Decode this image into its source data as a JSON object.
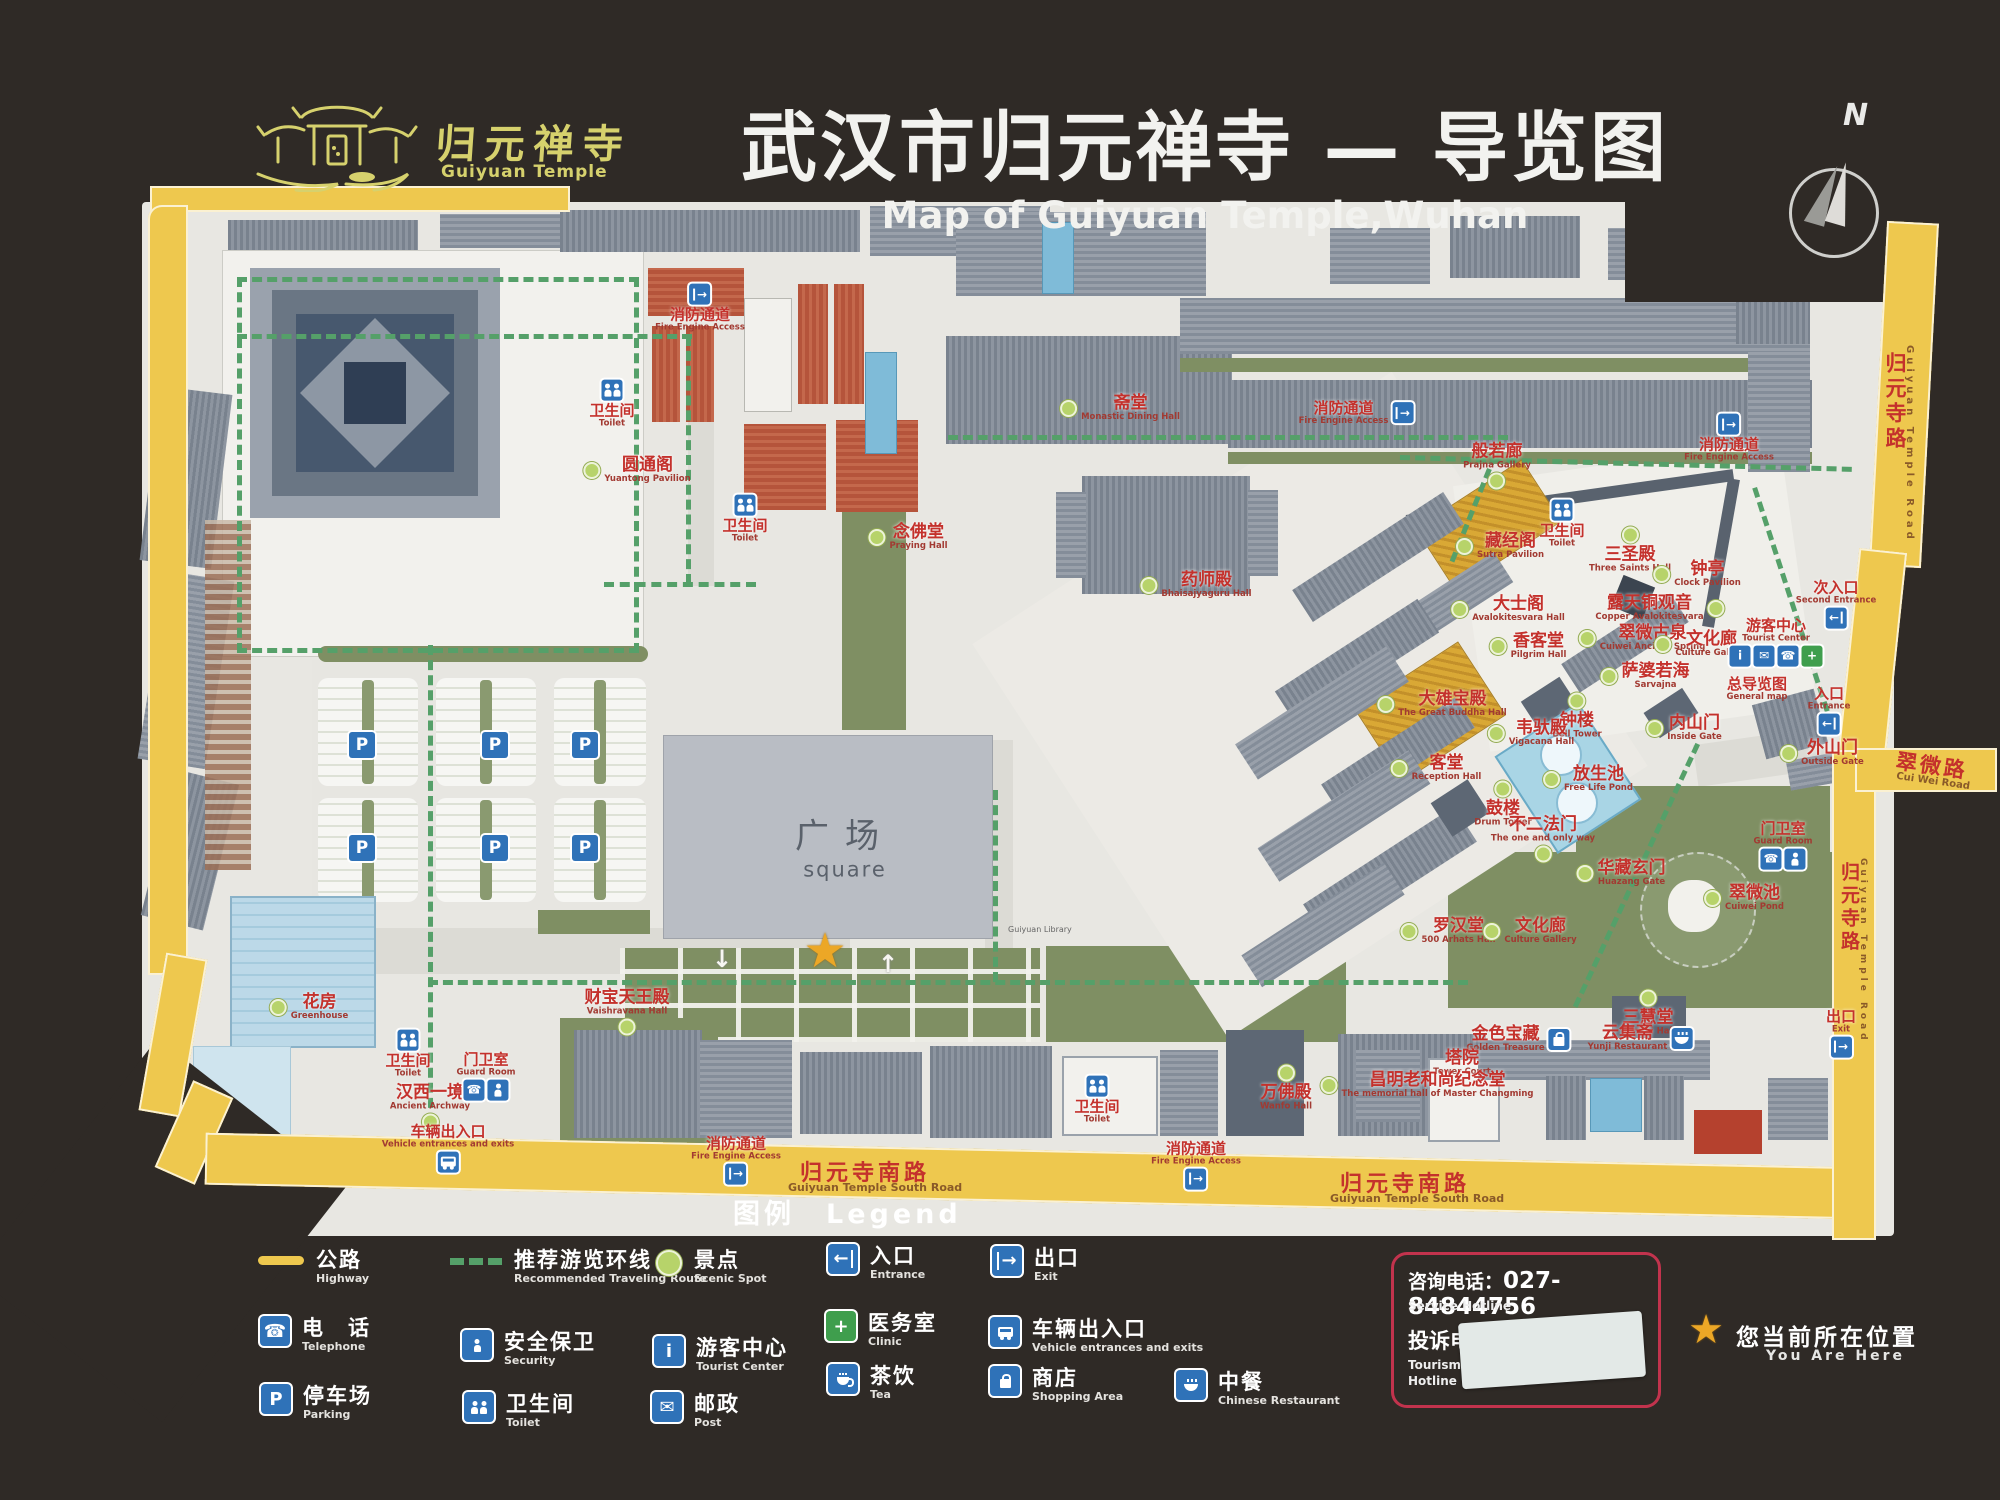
{
  "board": {
    "logo": {
      "name_zh": "归元禅寺",
      "name_en": "Guiyuan Temple"
    },
    "title_zh": "武汉市归元禅寺 — 导览图",
    "title_en": "Map of Guiyuan Temple,Wuhan",
    "compass_label": "N"
  },
  "map": {
    "square": {
      "zh": "广场",
      "en": "square"
    },
    "library_note": "Guiyuan Library",
    "roads": {
      "right_upper": {
        "zh": "归元寺路",
        "en": "Guiyuan Temple Road"
      },
      "right_lower": {
        "zh": "归元寺路",
        "en": "Guiyuan Temple Road"
      },
      "cuiwei": {
        "zh": "翠微路",
        "en": "Cui Wei Road"
      },
      "south_w": {
        "zh": "归元寺南路",
        "en": "Guiyuan Temple South Road"
      },
      "south_e": {
        "zh": "归元寺南路",
        "en": "Guiyuan Temple South Road"
      }
    },
    "spots": [
      {
        "zh": "圆通阁",
        "en": "Yuantong Pavilion",
        "x": 637,
        "y": 470,
        "dot": "left"
      },
      {
        "zh": "念佛堂",
        "en": "Praying Hall",
        "x": 908,
        "y": 537,
        "dot": "left"
      },
      {
        "zh": "斋堂",
        "en": "Monastic Dining Hall",
        "x": 1120,
        "y": 408,
        "dot": "left"
      },
      {
        "zh": "药师殿",
        "en": "Bhaisajyaguru Hall",
        "x": 1196,
        "y": 585,
        "dot": "left"
      },
      {
        "zh": "般若廊",
        "en": "Prajna Gallery",
        "x": 1497,
        "y": 466,
        "dot": "bottom"
      },
      {
        "zh": "藏经阁",
        "en": "Sutra Pavilion",
        "x": 1500,
        "y": 546,
        "dot": "left"
      },
      {
        "zh": "三圣殿",
        "en": "Three Saints Hall",
        "x": 1630,
        "y": 550,
        "dot": "top"
      },
      {
        "zh": "钟亭",
        "en": "Clock Pavilion",
        "x": 1697,
        "y": 574,
        "dot": "left"
      },
      {
        "zh": "大士阁",
        "en": "Avalokitesvara Hall",
        "x": 1508,
        "y": 609,
        "dot": "left"
      },
      {
        "zh": "露天铜观音",
        "en": "Copper Avalokitesvara",
        "x": 1660,
        "y": 608,
        "dot": "right"
      },
      {
        "zh": "翠微古泉",
        "en": "Cuiwei Ancient Spring",
        "x": 1642,
        "y": 638,
        "dot": "left"
      },
      {
        "zh": "文化廊",
        "en": "Culture Gallery",
        "x": 1701,
        "y": 644,
        "dot": "left"
      },
      {
        "zh": "香客堂",
        "en": "Pilgrim Hall",
        "x": 1528,
        "y": 646,
        "dot": "left"
      },
      {
        "zh": "萨婆若海",
        "en": "Sarvajna",
        "x": 1645,
        "y": 676,
        "dot": "left"
      },
      {
        "zh": "大雄宝殿",
        "en": "The Great Buddha Hall",
        "x": 1442,
        "y": 704,
        "dot": "left"
      },
      {
        "zh": "钟楼",
        "en": "Bell Tower",
        "x": 1577,
        "y": 716,
        "dot": "top"
      },
      {
        "zh": "韦驮殿",
        "en": "Vigacana Hall",
        "x": 1531,
        "y": 733,
        "dot": "left"
      },
      {
        "zh": "客堂",
        "en": "Reception Hall",
        "x": 1436,
        "y": 768,
        "dot": "left"
      },
      {
        "zh": "放生池",
        "en": "Free Life Pond",
        "x": 1588,
        "y": 779,
        "dot": "left"
      },
      {
        "zh": "鼓楼",
        "en": "Drum Tower",
        "x": 1503,
        "y": 804,
        "dot": "top"
      },
      {
        "zh": "不二法门",
        "en": "The one and only way",
        "x": 1543,
        "y": 839,
        "dot": "bottom"
      },
      {
        "zh": "华藏玄门",
        "en": "Huazang Gate",
        "x": 1621,
        "y": 873,
        "dot": "left"
      },
      {
        "zh": "内山门",
        "en": "Inside Gate",
        "x": 1684,
        "y": 728,
        "dot": "left"
      },
      {
        "zh": "外山门",
        "en": "Outside Gate",
        "x": 1822,
        "y": 753,
        "dot": "left"
      },
      {
        "zh": "罗汉堂",
        "en": "500 Arhats Hall",
        "x": 1448,
        "y": 931,
        "dot": "left"
      },
      {
        "zh": "文化廊",
        "en": "Culture Gallery",
        "x": 1530,
        "y": 931,
        "dot": "left"
      },
      {
        "zh": "翠微池",
        "en": "Cuiwei Pond",
        "x": 1744,
        "y": 898,
        "dot": "left"
      },
      {
        "zh": "三慧堂",
        "en": "Sanhui Hall",
        "x": 1648,
        "y": 1013,
        "dot": "top"
      },
      {
        "zh": "金色宝藏",
        "en": "Golden Treasure",
        "x": 1518,
        "y": 1039,
        "dot": "none",
        "icon": "shop"
      },
      {
        "zh": "云集斋",
        "en": "Yunji Restaurant",
        "x": 1640,
        "y": 1038,
        "dot": "none",
        "icon": "restaurant"
      },
      {
        "zh": "塔院",
        "en": "Tower Court",
        "x": 1462,
        "y": 1063,
        "dot": "none"
      },
      {
        "zh": "昌明老和尚纪念堂",
        "en": "The memorial hall of Master Changming",
        "x": 1427,
        "y": 1085,
        "dot": "left"
      },
      {
        "zh": "万佛殿",
        "en": "Wanfo Hall",
        "x": 1286,
        "y": 1088,
        "dot": "top"
      },
      {
        "zh": "汉西一境",
        "en": "Ancient Archway",
        "x": 430,
        "y": 1107,
        "dot": "bottom"
      },
      {
        "zh": "花房",
        "en": "Greenhouse",
        "x": 309,
        "y": 1007,
        "dot": "left"
      },
      {
        "zh": "财宝天王殿",
        "en": "Vaishravana Hall",
        "x": 627,
        "y": 1012,
        "dot": "bottom"
      }
    ],
    "facilities": [
      {
        "zh": "卫生间",
        "en": "Toilet",
        "x": 612,
        "y": 404,
        "icons": [
          "toilet"
        ],
        "ipos": "top"
      },
      {
        "zh": "卫生间",
        "en": "Toilet",
        "x": 745,
        "y": 519,
        "icons": [
          "toilet"
        ],
        "ipos": "top"
      },
      {
        "zh": "卫生间",
        "en": "Toilet",
        "x": 1562,
        "y": 524,
        "icons": [
          "toilet"
        ],
        "ipos": "top"
      },
      {
        "zh": "卫生间",
        "en": "Toilet",
        "x": 408,
        "y": 1054,
        "icons": [
          "toilet"
        ],
        "ipos": "top"
      },
      {
        "zh": "卫生间",
        "en": "Toilet",
        "x": 1097,
        "y": 1100,
        "icons": [
          "toilet"
        ],
        "ipos": "top"
      },
      {
        "zh": "门卫室",
        "en": "Guard Room",
        "x": 486,
        "y": 1076,
        "icons": [
          "phone",
          "security"
        ],
        "ipos": "bottom"
      },
      {
        "zh": "门卫室",
        "en": "Guard Room",
        "x": 1783,
        "y": 845,
        "icons": [
          "phone",
          "security"
        ],
        "ipos": "bottom"
      },
      {
        "zh": "游客中心",
        "en": "Tourist Center",
        "x": 1776,
        "y": 642,
        "icons": [
          "info",
          "post",
          "phone",
          "clinic"
        ],
        "ipos": "bottom"
      },
      {
        "zh": "车辆出入口",
        "en": "Vehicle entrances and exits",
        "x": 448,
        "y": 1148,
        "icons": [
          "bus"
        ],
        "ipos": "bottom"
      },
      {
        "zh": "入口",
        "en": "Entrance",
        "x": 1829,
        "y": 710,
        "icons": [
          "entrance"
        ],
        "ipos": "bottom"
      },
      {
        "zh": "次入口",
        "en": "Second Entrance",
        "x": 1836,
        "y": 604,
        "icons": [
          "entrance"
        ],
        "ipos": "bottom"
      },
      {
        "zh": "出口",
        "en": "Exit",
        "x": 1841,
        "y": 1033,
        "icons": [
          "exit"
        ],
        "ipos": "bottom"
      },
      {
        "zh": "总导览图",
        "en": "General map",
        "x": 1757,
        "y": 689,
        "icons": [],
        "ipos": "none"
      }
    ],
    "fire_access": {
      "zh": "消防通道",
      "en": "Fire Engine Access",
      "points": [
        {
          "x": 700,
          "y": 308,
          "ipos": "top"
        },
        {
          "x": 1356,
          "y": 413,
          "ipos": "right"
        },
        {
          "x": 1729,
          "y": 438,
          "ipos": "top"
        },
        {
          "x": 736,
          "y": 1160,
          "ipos": "bottom"
        },
        {
          "x": 1196,
          "y": 1165,
          "ipos": "bottom"
        }
      ]
    },
    "parking_signs": [
      [
        362,
        745
      ],
      [
        495,
        745
      ],
      [
        585,
        745
      ],
      [
        362,
        848
      ],
      [
        495,
        848
      ],
      [
        585,
        848
      ]
    ],
    "parking_letter": "P"
  },
  "legend": {
    "title_zh": "图例",
    "title_en": "Legend",
    "items": [
      {
        "zh": "公路",
        "en": "Highway",
        "icon": "highway",
        "x": 258,
        "y": 1248
      },
      {
        "zh": "推荐游览环线",
        "en": "Recommended Traveling Route",
        "icon": "route",
        "x": 450,
        "y": 1248
      },
      {
        "zh": "景点",
        "en": "Scenic Spot",
        "icon": "spot",
        "x": 656,
        "y": 1248
      },
      {
        "zh": "入口",
        "en": "Entrance",
        "icon": "entrance",
        "x": 828,
        "y": 1244
      },
      {
        "zh": "出口",
        "en": "Exit",
        "icon": "exit",
        "x": 992,
        "y": 1246
      },
      {
        "zh": "电　话",
        "en": "Telephone",
        "icon": "phone",
        "x": 260,
        "y": 1316
      },
      {
        "zh": "安全保卫",
        "en": "Security",
        "icon": "security",
        "x": 462,
        "y": 1330
      },
      {
        "zh": "游客中心",
        "en": "Tourist Center",
        "icon": "info",
        "x": 654,
        "y": 1336
      },
      {
        "zh": "医务室",
        "en": "Clinic",
        "icon": "clinic",
        "x": 826,
        "y": 1311
      },
      {
        "zh": "车辆出入口",
        "en": "Vehicle entrances and exits",
        "icon": "bus",
        "x": 990,
        "y": 1317
      },
      {
        "zh": "停车场",
        "en": "Parking",
        "icon": "parking",
        "x": 261,
        "y": 1384
      },
      {
        "zh": "卫生间",
        "en": "Toilet",
        "icon": "toilet",
        "x": 464,
        "y": 1392
      },
      {
        "zh": "邮政",
        "en": "Post",
        "icon": "post",
        "x": 652,
        "y": 1392
      },
      {
        "zh": "茶饮",
        "en": "Tea",
        "icon": "tea",
        "x": 828,
        "y": 1364
      },
      {
        "zh": "商店",
        "en": "Shopping Area",
        "icon": "shop",
        "x": 990,
        "y": 1366
      },
      {
        "zh": "中餐",
        "en": "Chinese Restaurant",
        "icon": "restaurant",
        "x": 1176,
        "y": 1370
      }
    ]
  },
  "hotline": {
    "service_label": "咨询电话：",
    "service_number": "027-84844756",
    "service_en": "Service Hotline",
    "complaint_label": "投诉电话",
    "complaint_en_1": "Tourism S",
    "complaint_en_2": "Hotline"
  },
  "you_are_here": {
    "zh": "您当前所在位置",
    "en": "You Are Here",
    "star": "★"
  }
}
